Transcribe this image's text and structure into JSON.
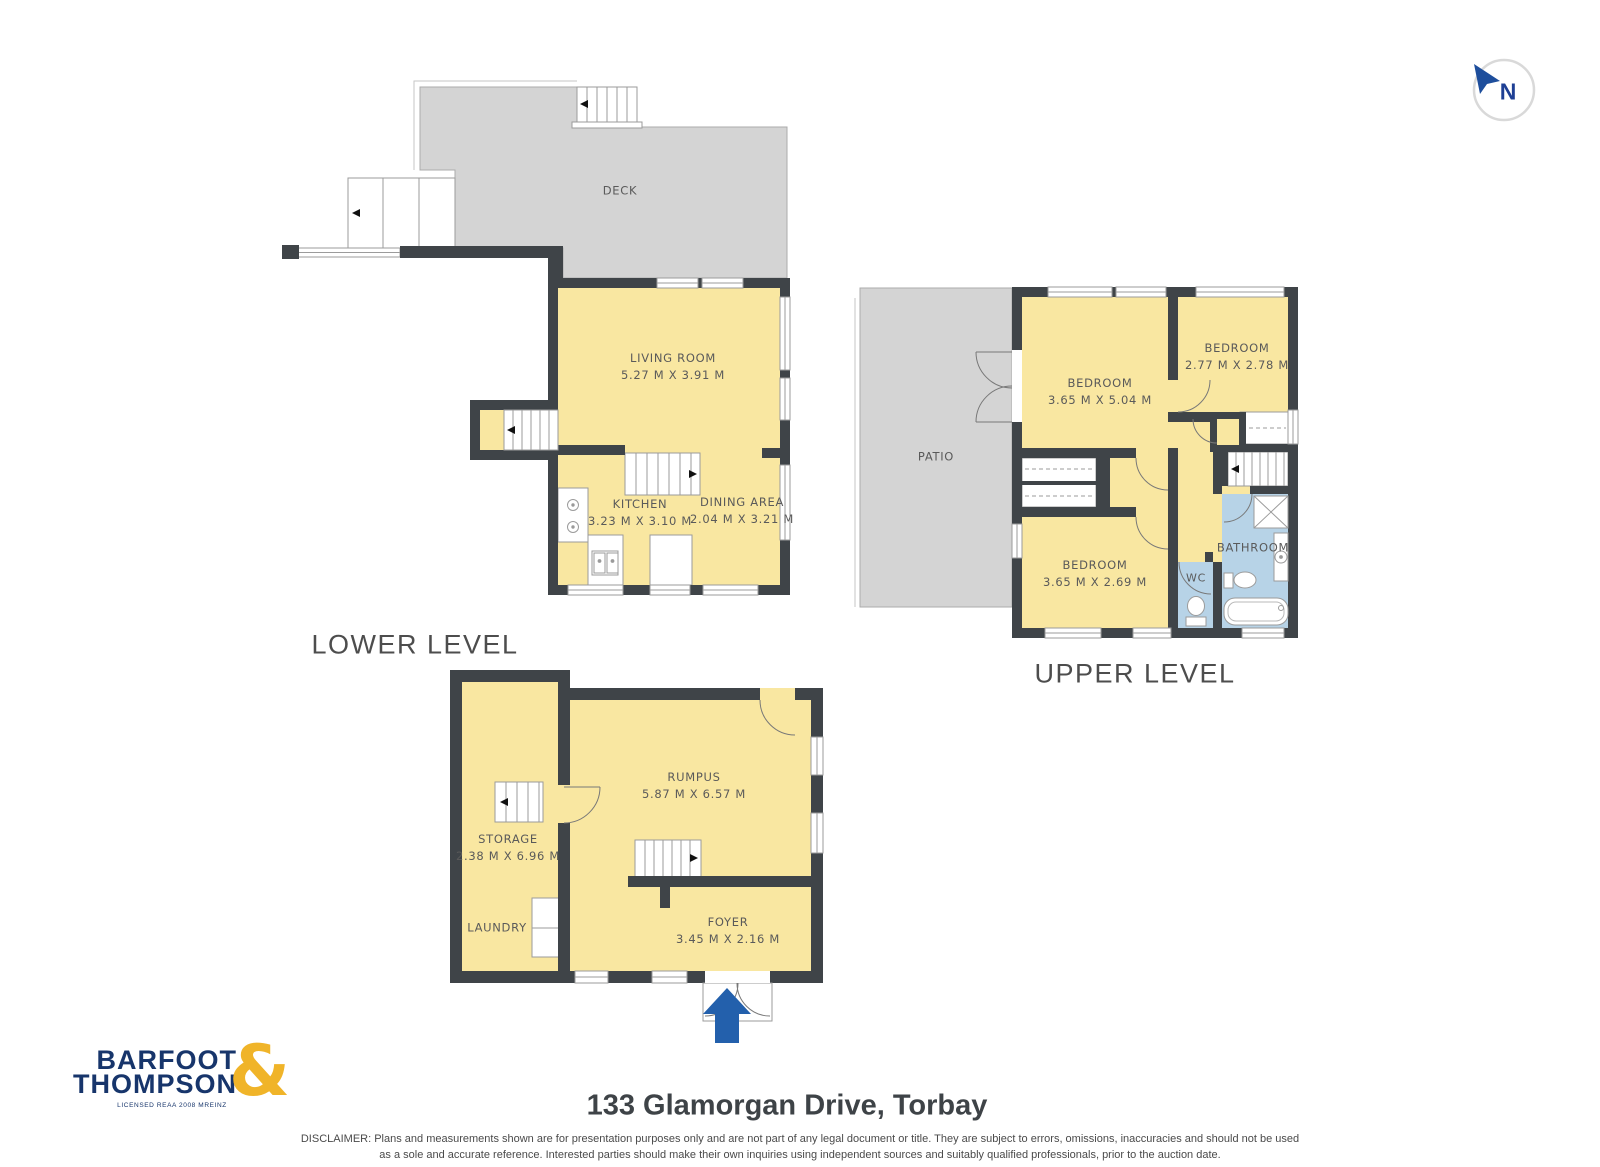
{
  "compass": {
    "label": "N"
  },
  "levels": {
    "lower": {
      "label": "LOWER LEVEL",
      "rooms": {
        "deck": {
          "name": "DECK"
        },
        "living": {
          "name": "LIVING ROOM",
          "dims": "5.27 M X 3.91 M"
        },
        "kitchen": {
          "name": "KITCHEN",
          "dims": "3.23 M X 3.10 M"
        },
        "dining": {
          "name": "DINING AREA",
          "dims": "2.04 M X 3.21 M"
        }
      }
    },
    "upper": {
      "label": "UPPER LEVEL",
      "rooms": {
        "patio": {
          "name": "PATIO"
        },
        "bedroom1": {
          "name": "BEDROOM",
          "dims": "3.65 M X 5.04 M"
        },
        "bedroom2": {
          "name": "BEDROOM",
          "dims": "2.77 M X 2.78 M"
        },
        "bedroom3": {
          "name": "BEDROOM",
          "dims": "3.65 M X 2.69 M"
        },
        "bathroom": {
          "name": "BATHROOM"
        },
        "wc": {
          "name": "WC"
        }
      }
    },
    "basement": {
      "rooms": {
        "storage": {
          "name": "STORAGE",
          "dims": "2.38 M X 6.96 M"
        },
        "laundry": {
          "name": "LAUNDRY"
        },
        "rumpus": {
          "name": "RUMPUS",
          "dims": "5.87 M X 6.57 M"
        },
        "foyer": {
          "name": "FOYER",
          "dims": "3.45 M X 2.16 M"
        }
      }
    }
  },
  "footer": {
    "address": "133 Glamorgan Drive, Torbay",
    "disclaimer_line1": "DISCLAIMER: Plans and measurements shown are for presentation purposes only and are not part of any legal document or title. They are subject to errors, omissions, inaccuracies and should not be used",
    "disclaimer_line2": "as a sole and accurate reference. Interested parties should make their own inquiries using independent sources and suitably qualified professionals, prior to the auction date."
  },
  "logo": {
    "line1": "BARFOOT",
    "line2": "THOMPSON",
    "ampersand": "&",
    "tagline": "LICENSED REAA 2008 MREINZ"
  },
  "colors": {
    "wall": "#3F4448",
    "floor_yellow": "#F9E7A1",
    "deck_gray": "#D4D4D4",
    "wet_blue": "#B7D3E7",
    "logo_navy": "#17356B",
    "logo_gold": "#F0B429",
    "arrow_blue": "#2360AC"
  }
}
